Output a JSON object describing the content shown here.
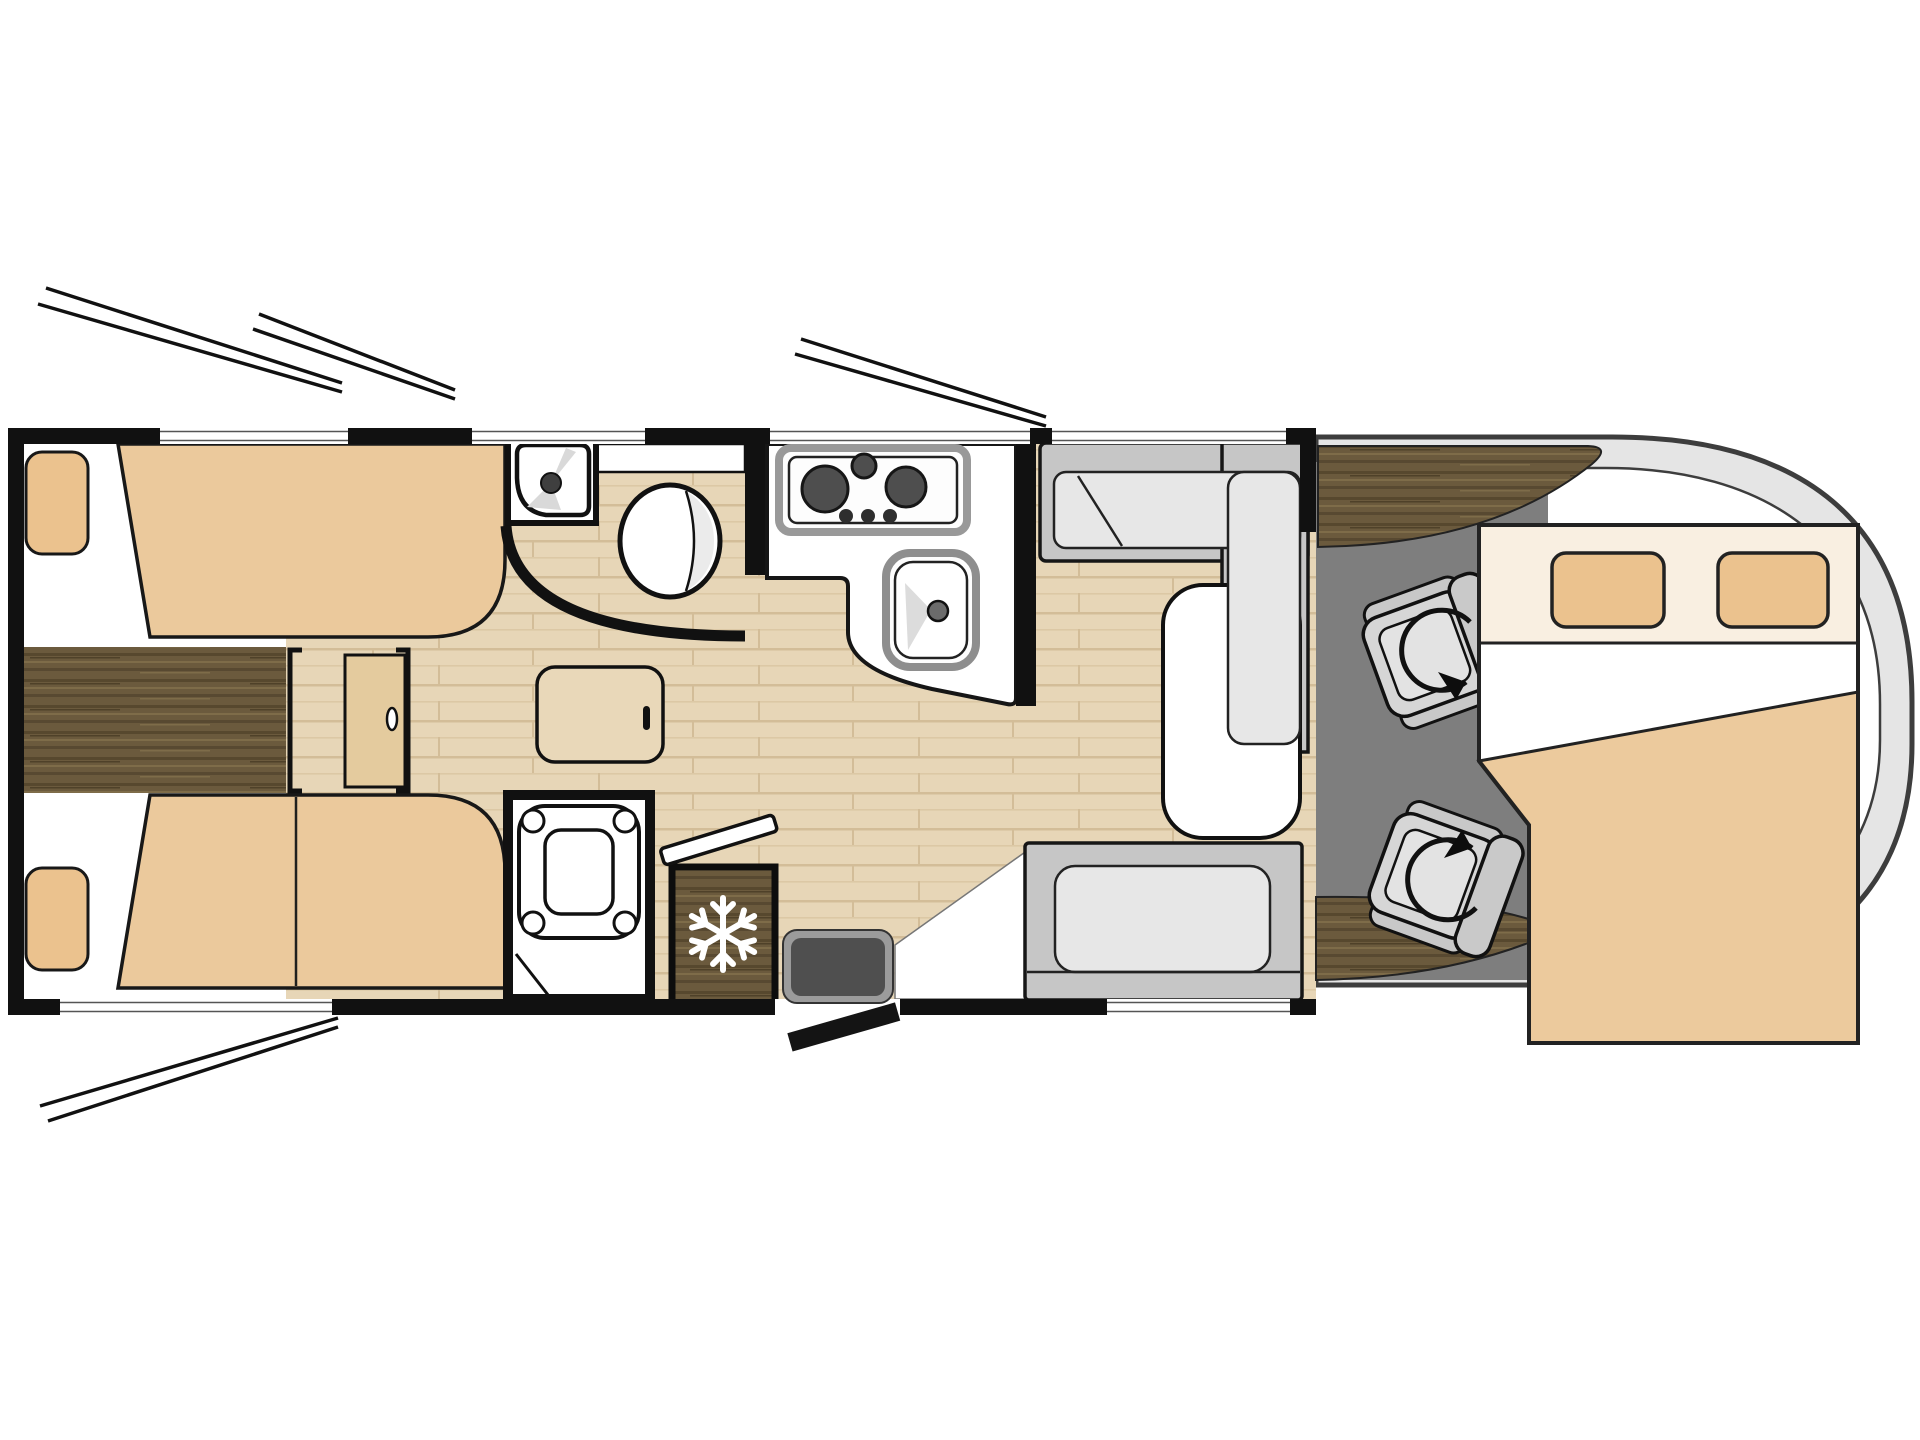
{
  "meta": {
    "title": "Motorhome floor plan (top view)",
    "diagram_type": "rv-floorplan",
    "visible_text": "none"
  },
  "colors": {
    "wall": "#111111",
    "interior": "#ffffff",
    "bed_tan": "#ebc99c",
    "pillow_tan": "#ebc28e",
    "front_bed_band": "#f9efe1",
    "front_bed_blanket": "#ecca9d",
    "door_leaf": "#e4cb9e",
    "cabinet_face": "#e9d8b9",
    "parquet_base": "#e7d6b7",
    "parquet_line": "#d3bd98",
    "walnut_base": "#6b5a3d",
    "walnut_streak_dark": "#57482e",
    "walnut_streak_light": "#7e6c49",
    "cab_floor": "#7e7e7e",
    "cap_body": "#e5e5e5",
    "bench_base": "#c6c6c6",
    "bench_cushion": "#e7e7e7",
    "seat_body": "#d6d6d6",
    "seat_back": "#c9c9c9",
    "seat_inner": "#e3e3e3",
    "table_top": "#ffffff",
    "counter_top": "#ffffff",
    "appliance_steel": "#909090",
    "burner_dark": "#4e4e4e",
    "mat_outer": "#9b9b9b",
    "mat_inner": "#4f4f4f",
    "toilet_shade": "#ebebeb",
    "basin_shade": "#d9d9d9"
  },
  "vehicle": {
    "sections": [
      {
        "name": "rear-bedroom",
        "features": [
          "twin bed top",
          "twin bed bottom",
          "2 pillows",
          "dark wood centre aisle",
          "sliding pocket door",
          "bedside cabinet",
          "wardrobe seam"
        ]
      },
      {
        "name": "washroom",
        "features": [
          "corner washbasin unit",
          "toilet",
          "curved sliding door wall",
          "top window"
        ]
      },
      {
        "name": "shower-room",
        "features": [
          "shower tray with 4 corner caps",
          "folding door",
          "open door leaf"
        ]
      },
      {
        "name": "kitchen",
        "features": [
          "3-burner hob (2 large, 1 small)",
          "3 control knobs",
          "sink with faucet",
          "L-shaped counter",
          "refrigerator with snowflake symbol"
        ]
      },
      {
        "name": "dinette",
        "features": [
          "L-shaped bench",
          "rear bench",
          "white pedestal table",
          "window behind bench"
        ]
      },
      {
        "name": "cab",
        "features": [
          "driver swivel seat with rotation arrow",
          "passenger swivel seat with rotation arrow",
          "dark wood dashboard crescents",
          "grey cab floor",
          "rounded front cap"
        ]
      },
      {
        "name": "front-drop-down-bed",
        "features": [
          "head band with 2 pillows",
          "white sheet with diagonal fold",
          "tan blanket"
        ]
      },
      {
        "name": "entry",
        "features": [
          "entry step mat",
          "open door leaf outside",
          "open door bar inside"
        ]
      }
    ],
    "window_open_panes": 4,
    "wall_window_gaps": 6,
    "swivel_seats": 2,
    "berths": 3
  }
}
